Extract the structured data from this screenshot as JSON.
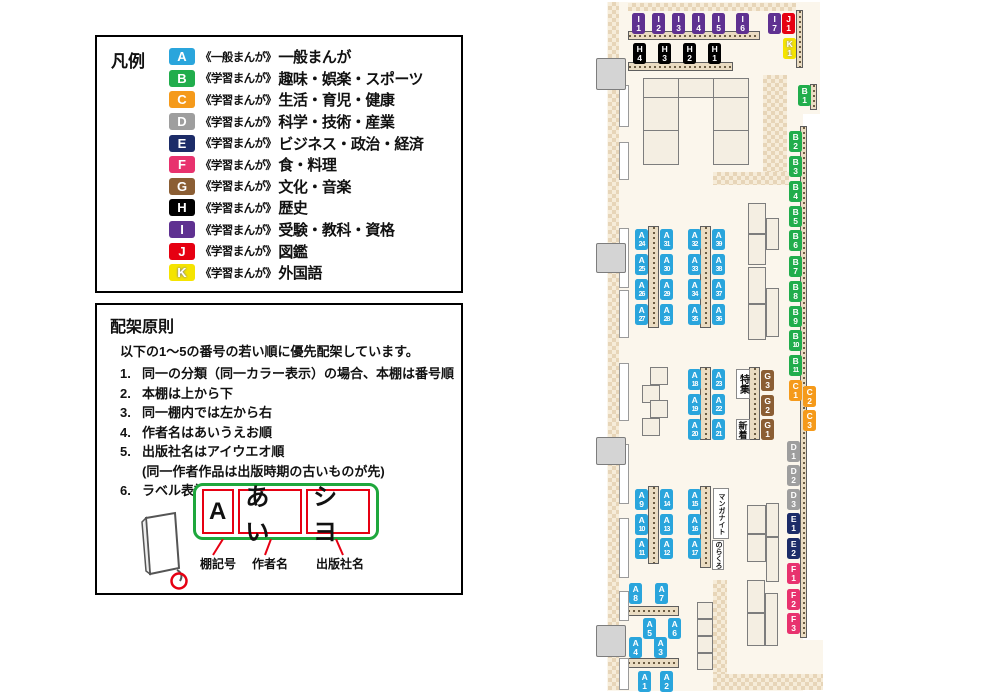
{
  "legend": {
    "title": "凡例",
    "items": [
      {
        "code": "A",
        "color": "#2aa5dc",
        "series": "《一般まんが》",
        "label": "一般まんが"
      },
      {
        "code": "B",
        "color": "#21ad4c",
        "series": "《学習まんが》",
        "label": "趣味・娯楽・スポーツ"
      },
      {
        "code": "C",
        "color": "#f59a1b",
        "series": "《学習まんが》",
        "label": "生活・育児・健康"
      },
      {
        "code": "D",
        "color": "#9e9e9e",
        "series": "《学習まんが》",
        "label": "科学・技術・産業"
      },
      {
        "code": "E",
        "color": "#1c2c68",
        "series": "《学習まんが》",
        "label": "ビジネス・政治・経済"
      },
      {
        "code": "F",
        "color": "#e8326e",
        "series": "《学習まんが》",
        "label": "食・料理"
      },
      {
        "code": "G",
        "color": "#8b5e34",
        "series": "《学習まんが》",
        "label": "文化・音楽"
      },
      {
        "code": "H",
        "color": "#000000",
        "series": "《学習まんが》",
        "label": "歴史"
      },
      {
        "code": "I",
        "color": "#5f3191",
        "series": "《学習まんが》",
        "label": "受験・教科・資格"
      },
      {
        "code": "J",
        "color": "#e60012",
        "series": "《学習まんが》",
        "label": "図鑑"
      },
      {
        "code": "K",
        "color": "#f5e400",
        "series": "《学習まんが》",
        "label": "外国語"
      }
    ]
  },
  "principles": {
    "title": "配架原則",
    "intro": "以下の1～5の番号の若い順に優先配架しています。",
    "rules": [
      {
        "num": "1.",
        "text": "同一の分類（同一カラー表示）の場合、本棚は番号順"
      },
      {
        "num": "2.",
        "text": "本棚は上から下"
      },
      {
        "num": "3.",
        "text": "同一棚内では左から右"
      },
      {
        "num": "4.",
        "text": "作者名はあいうえお順"
      },
      {
        "num": "5.",
        "text": "出版社名はアイウエオ順",
        "sub": "(同一作者作品は出版時期の古いものが先)"
      },
      {
        "num": "6.",
        "text": "ラベル表記は下図の通り"
      }
    ],
    "label_example": {
      "parts": [
        {
          "text": "A",
          "caption": "棚記号"
        },
        {
          "text": "あい",
          "caption": "作者名"
        },
        {
          "text": "シヨ",
          "caption": "出版社名"
        }
      ]
    }
  },
  "map": {
    "shelf_labels": [
      {
        "cat": "A",
        "num": "1",
        "x": 638,
        "y": 671
      },
      {
        "cat": "A",
        "num": "2",
        "x": 660,
        "y": 671
      },
      {
        "cat": "A",
        "num": "3",
        "x": 654,
        "y": 637
      },
      {
        "cat": "A",
        "num": "4",
        "x": 629,
        "y": 637
      },
      {
        "cat": "A",
        "num": "5",
        "x": 643,
        "y": 618
      },
      {
        "cat": "A",
        "num": "6",
        "x": 668,
        "y": 618
      },
      {
        "cat": "A",
        "num": "7",
        "x": 655,
        "y": 583
      },
      {
        "cat": "A",
        "num": "8",
        "x": 629,
        "y": 583
      },
      {
        "cat": "A",
        "num": "9",
        "x": 635,
        "y": 489
      },
      {
        "cat": "A",
        "num": "10",
        "x": 635,
        "y": 514
      },
      {
        "cat": "A",
        "num": "11",
        "x": 635,
        "y": 538
      },
      {
        "cat": "A",
        "num": "12",
        "x": 660,
        "y": 538
      },
      {
        "cat": "A",
        "num": "13",
        "x": 660,
        "y": 514
      },
      {
        "cat": "A",
        "num": "14",
        "x": 660,
        "y": 489
      },
      {
        "cat": "A",
        "num": "15",
        "x": 688,
        "y": 489
      },
      {
        "cat": "A",
        "num": "16",
        "x": 688,
        "y": 514
      },
      {
        "cat": "A",
        "num": "17",
        "x": 688,
        "y": 538
      },
      {
        "cat": "A",
        "num": "18",
        "x": 688,
        "y": 369
      },
      {
        "cat": "A",
        "num": "19",
        "x": 688,
        "y": 394
      },
      {
        "cat": "A",
        "num": "20",
        "x": 688,
        "y": 419
      },
      {
        "cat": "A",
        "num": "21",
        "x": 712,
        "y": 419
      },
      {
        "cat": "A",
        "num": "22",
        "x": 712,
        "y": 394
      },
      {
        "cat": "A",
        "num": "23",
        "x": 712,
        "y": 369
      },
      {
        "cat": "A",
        "num": "24",
        "x": 635,
        "y": 229
      },
      {
        "cat": "A",
        "num": "25",
        "x": 635,
        "y": 254
      },
      {
        "cat": "A",
        "num": "26",
        "x": 635,
        "y": 279
      },
      {
        "cat": "A",
        "num": "27",
        "x": 635,
        "y": 304
      },
      {
        "cat": "A",
        "num": "28",
        "x": 660,
        "y": 304
      },
      {
        "cat": "A",
        "num": "29",
        "x": 660,
        "y": 279
      },
      {
        "cat": "A",
        "num": "30",
        "x": 660,
        "y": 254
      },
      {
        "cat": "A",
        "num": "31",
        "x": 660,
        "y": 229
      },
      {
        "cat": "A",
        "num": "32",
        "x": 688,
        "y": 229
      },
      {
        "cat": "A",
        "num": "33",
        "x": 688,
        "y": 254
      },
      {
        "cat": "A",
        "num": "34",
        "x": 688,
        "y": 279
      },
      {
        "cat": "A",
        "num": "35",
        "x": 688,
        "y": 304
      },
      {
        "cat": "A",
        "num": "36",
        "x": 712,
        "y": 304
      },
      {
        "cat": "A",
        "num": "37",
        "x": 712,
        "y": 279
      },
      {
        "cat": "A",
        "num": "38",
        "x": 712,
        "y": 254
      },
      {
        "cat": "A",
        "num": "39",
        "x": 712,
        "y": 229
      },
      {
        "cat": "B",
        "num": "1",
        "x": 798,
        "y": 85
      },
      {
        "cat": "B",
        "num": "2",
        "x": 789,
        "y": 131
      },
      {
        "cat": "B",
        "num": "3",
        "x": 789,
        "y": 156
      },
      {
        "cat": "B",
        "num": "4",
        "x": 789,
        "y": 181
      },
      {
        "cat": "B",
        "num": "5",
        "x": 789,
        "y": 206
      },
      {
        "cat": "B",
        "num": "6",
        "x": 789,
        "y": 230
      },
      {
        "cat": "B",
        "num": "7",
        "x": 789,
        "y": 256
      },
      {
        "cat": "B",
        "num": "8",
        "x": 789,
        "y": 281
      },
      {
        "cat": "B",
        "num": "9",
        "x": 789,
        "y": 306
      },
      {
        "cat": "B",
        "num": "10",
        "x": 789,
        "y": 330
      },
      {
        "cat": "B",
        "num": "11",
        "x": 789,
        "y": 355
      },
      {
        "cat": "C",
        "num": "1",
        "x": 789,
        "y": 380
      },
      {
        "cat": "C",
        "num": "2",
        "x": 803,
        "y": 386
      },
      {
        "cat": "C",
        "num": "3",
        "x": 803,
        "y": 410
      },
      {
        "cat": "D",
        "num": "1",
        "x": 787,
        "y": 441
      },
      {
        "cat": "D",
        "num": "2",
        "x": 787,
        "y": 465
      },
      {
        "cat": "D",
        "num": "3",
        "x": 787,
        "y": 489
      },
      {
        "cat": "E",
        "num": "1",
        "x": 787,
        "y": 513
      },
      {
        "cat": "E",
        "num": "2",
        "x": 787,
        "y": 538
      },
      {
        "cat": "F",
        "num": "1",
        "x": 787,
        "y": 563
      },
      {
        "cat": "F",
        "num": "2",
        "x": 787,
        "y": 589
      },
      {
        "cat": "F",
        "num": "3",
        "x": 787,
        "y": 613
      },
      {
        "cat": "G",
        "num": "1",
        "x": 761,
        "y": 419
      },
      {
        "cat": "G",
        "num": "2",
        "x": 761,
        "y": 395
      },
      {
        "cat": "G",
        "num": "3",
        "x": 761,
        "y": 370
      },
      {
        "cat": "H",
        "num": "1",
        "x": 708,
        "y": 43
      },
      {
        "cat": "H",
        "num": "2",
        "x": 683,
        "y": 43
      },
      {
        "cat": "H",
        "num": "3",
        "x": 658,
        "y": 43
      },
      {
        "cat": "H",
        "num": "4",
        "x": 633,
        "y": 43
      },
      {
        "cat": "I",
        "num": "1",
        "x": 632,
        "y": 13
      },
      {
        "cat": "I",
        "num": "2",
        "x": 652,
        "y": 13
      },
      {
        "cat": "I",
        "num": "3",
        "x": 672,
        "y": 13
      },
      {
        "cat": "I",
        "num": "4",
        "x": 692,
        "y": 13
      },
      {
        "cat": "I",
        "num": "5",
        "x": 712,
        "y": 13
      },
      {
        "cat": "I",
        "num": "6",
        "x": 736,
        "y": 13
      },
      {
        "cat": "I",
        "num": "7",
        "x": 768,
        "y": 13
      },
      {
        "cat": "J",
        "num": "1",
        "x": 782,
        "y": 13
      },
      {
        "cat": "K",
        "num": "1",
        "x": 783,
        "y": 38
      }
    ],
    "text_labels": [
      {
        "name": "special-feature-label",
        "text": "特集",
        "x": 736,
        "y": 369,
        "w": 14,
        "h": 30,
        "fs": 10
      },
      {
        "name": "new-arrivals-label",
        "text": "新着",
        "x": 736,
        "y": 419,
        "w": 14,
        "h": 21,
        "fs": 9
      },
      {
        "name": "manga-night-label",
        "text": "マンガナイト",
        "x": 713,
        "y": 488,
        "w": 16,
        "h": 51,
        "fs": 7
      },
      {
        "name": "norakuro-label",
        "text": "のらくろ",
        "x": 712,
        "y": 540,
        "w": 12,
        "h": 30,
        "fs": 7
      }
    ]
  }
}
